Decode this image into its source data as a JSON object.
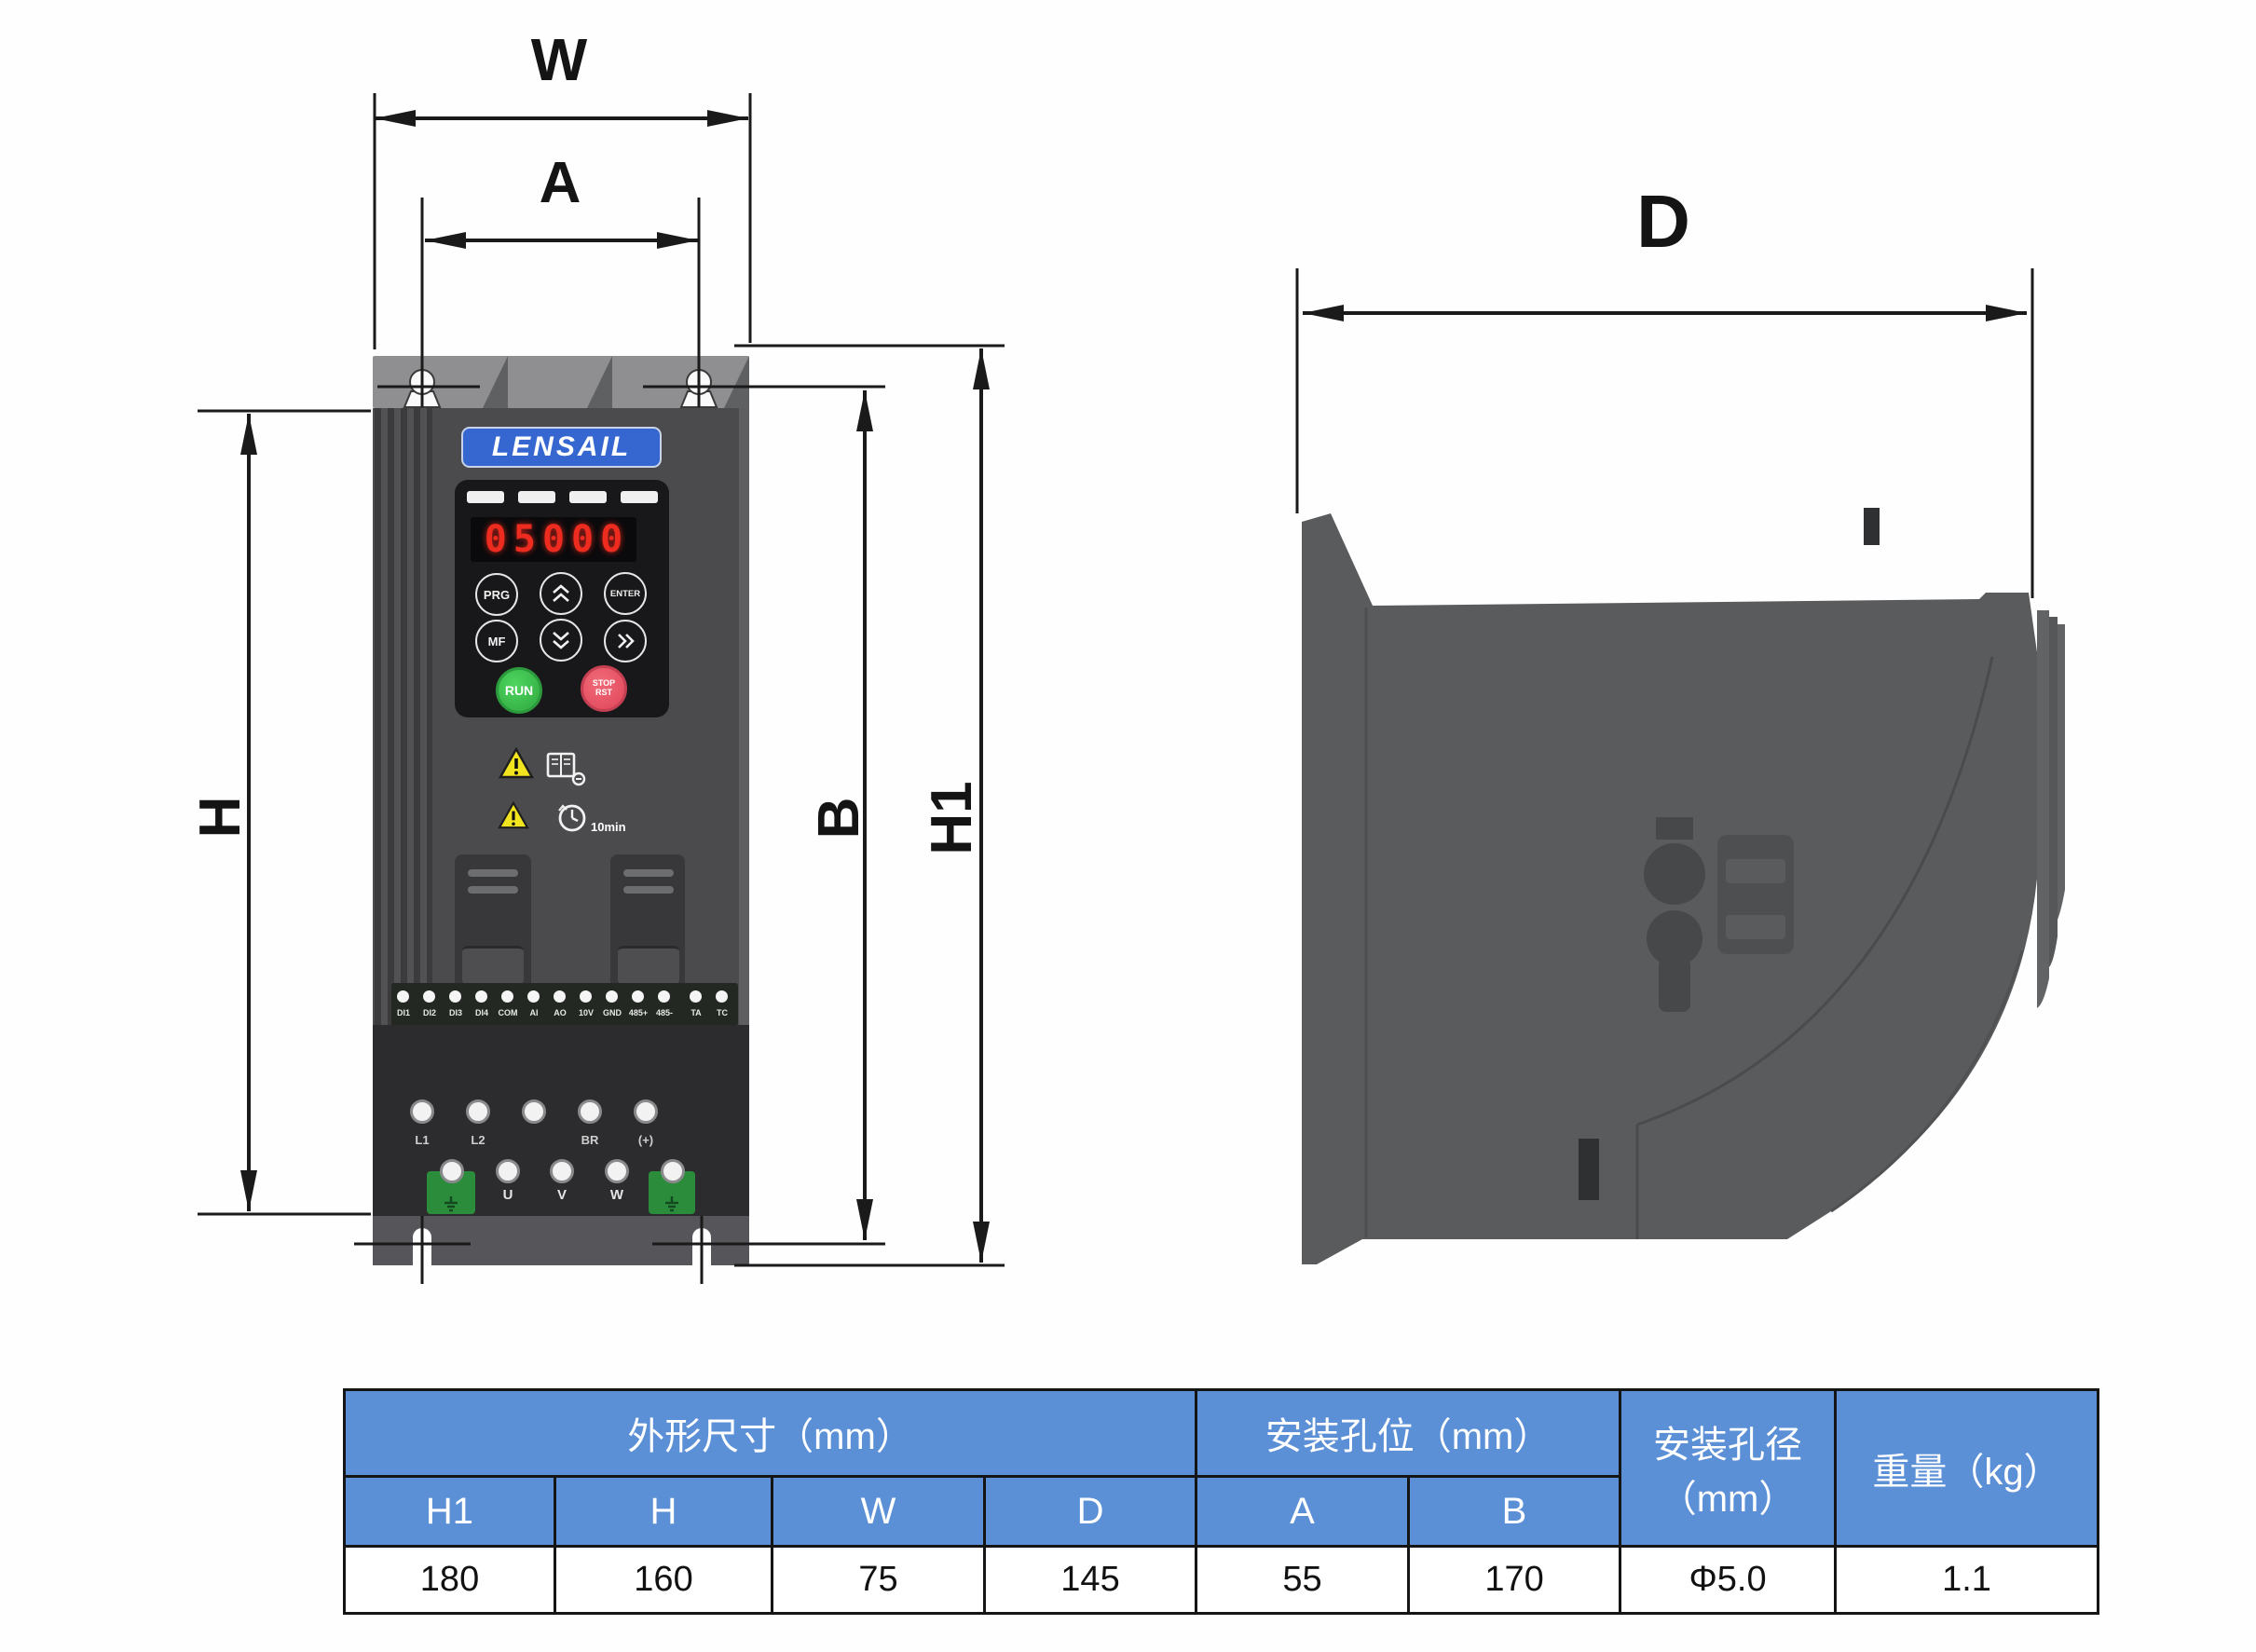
{
  "dimensions": {
    "front_width": "W",
    "front_hole_spacing_h": "A",
    "front_height": "H",
    "front_hole_spacing_v": "B",
    "front_total_height": "H1",
    "side_depth": "D"
  },
  "device": {
    "brand": "LENSAIL",
    "led_display": "05000",
    "keypad": {
      "prg": "PRG",
      "mf": "MF",
      "enter": "ENTER",
      "run": "RUN",
      "stop_line1": "STOP",
      "stop_line2": "RST"
    },
    "discharge_wait_note": "10min",
    "signal_terminals": [
      "DI1",
      "DI2",
      "DI3",
      "DI4",
      "COM",
      "AI",
      "AO",
      "10V",
      "GND",
      "485+",
      "485-",
      "TA",
      "TC"
    ],
    "power_terminals_top": [
      "L1",
      "L2",
      "BR",
      "(+)"
    ],
    "power_terminals_bottom": [
      "U",
      "V",
      "W"
    ]
  },
  "table": {
    "header_outline": "外形尺寸（mm）",
    "header_mounting": "安装孔位（mm）",
    "header_hole_dia_line1": "安装孔径",
    "header_hole_dia_line2": "（mm）",
    "header_weight": "重量（kg）",
    "columns": [
      "H1",
      "H",
      "W",
      "D",
      "A",
      "B"
    ],
    "values": [
      "180",
      "160",
      "75",
      "145",
      "55",
      "170",
      "Φ5.0",
      "1.1"
    ]
  },
  "colors": {
    "table_header_blue": "#5B8FD6",
    "logo_blue": "#3667D0",
    "led_red": "#EE2B1F",
    "run_green": "#3CC14D",
    "stop_red": "#E85060",
    "warning_yellow": "#F2E41F",
    "front_body_gray": "#4B4B4D",
    "side_body_gray": "#5A5B5D"
  }
}
